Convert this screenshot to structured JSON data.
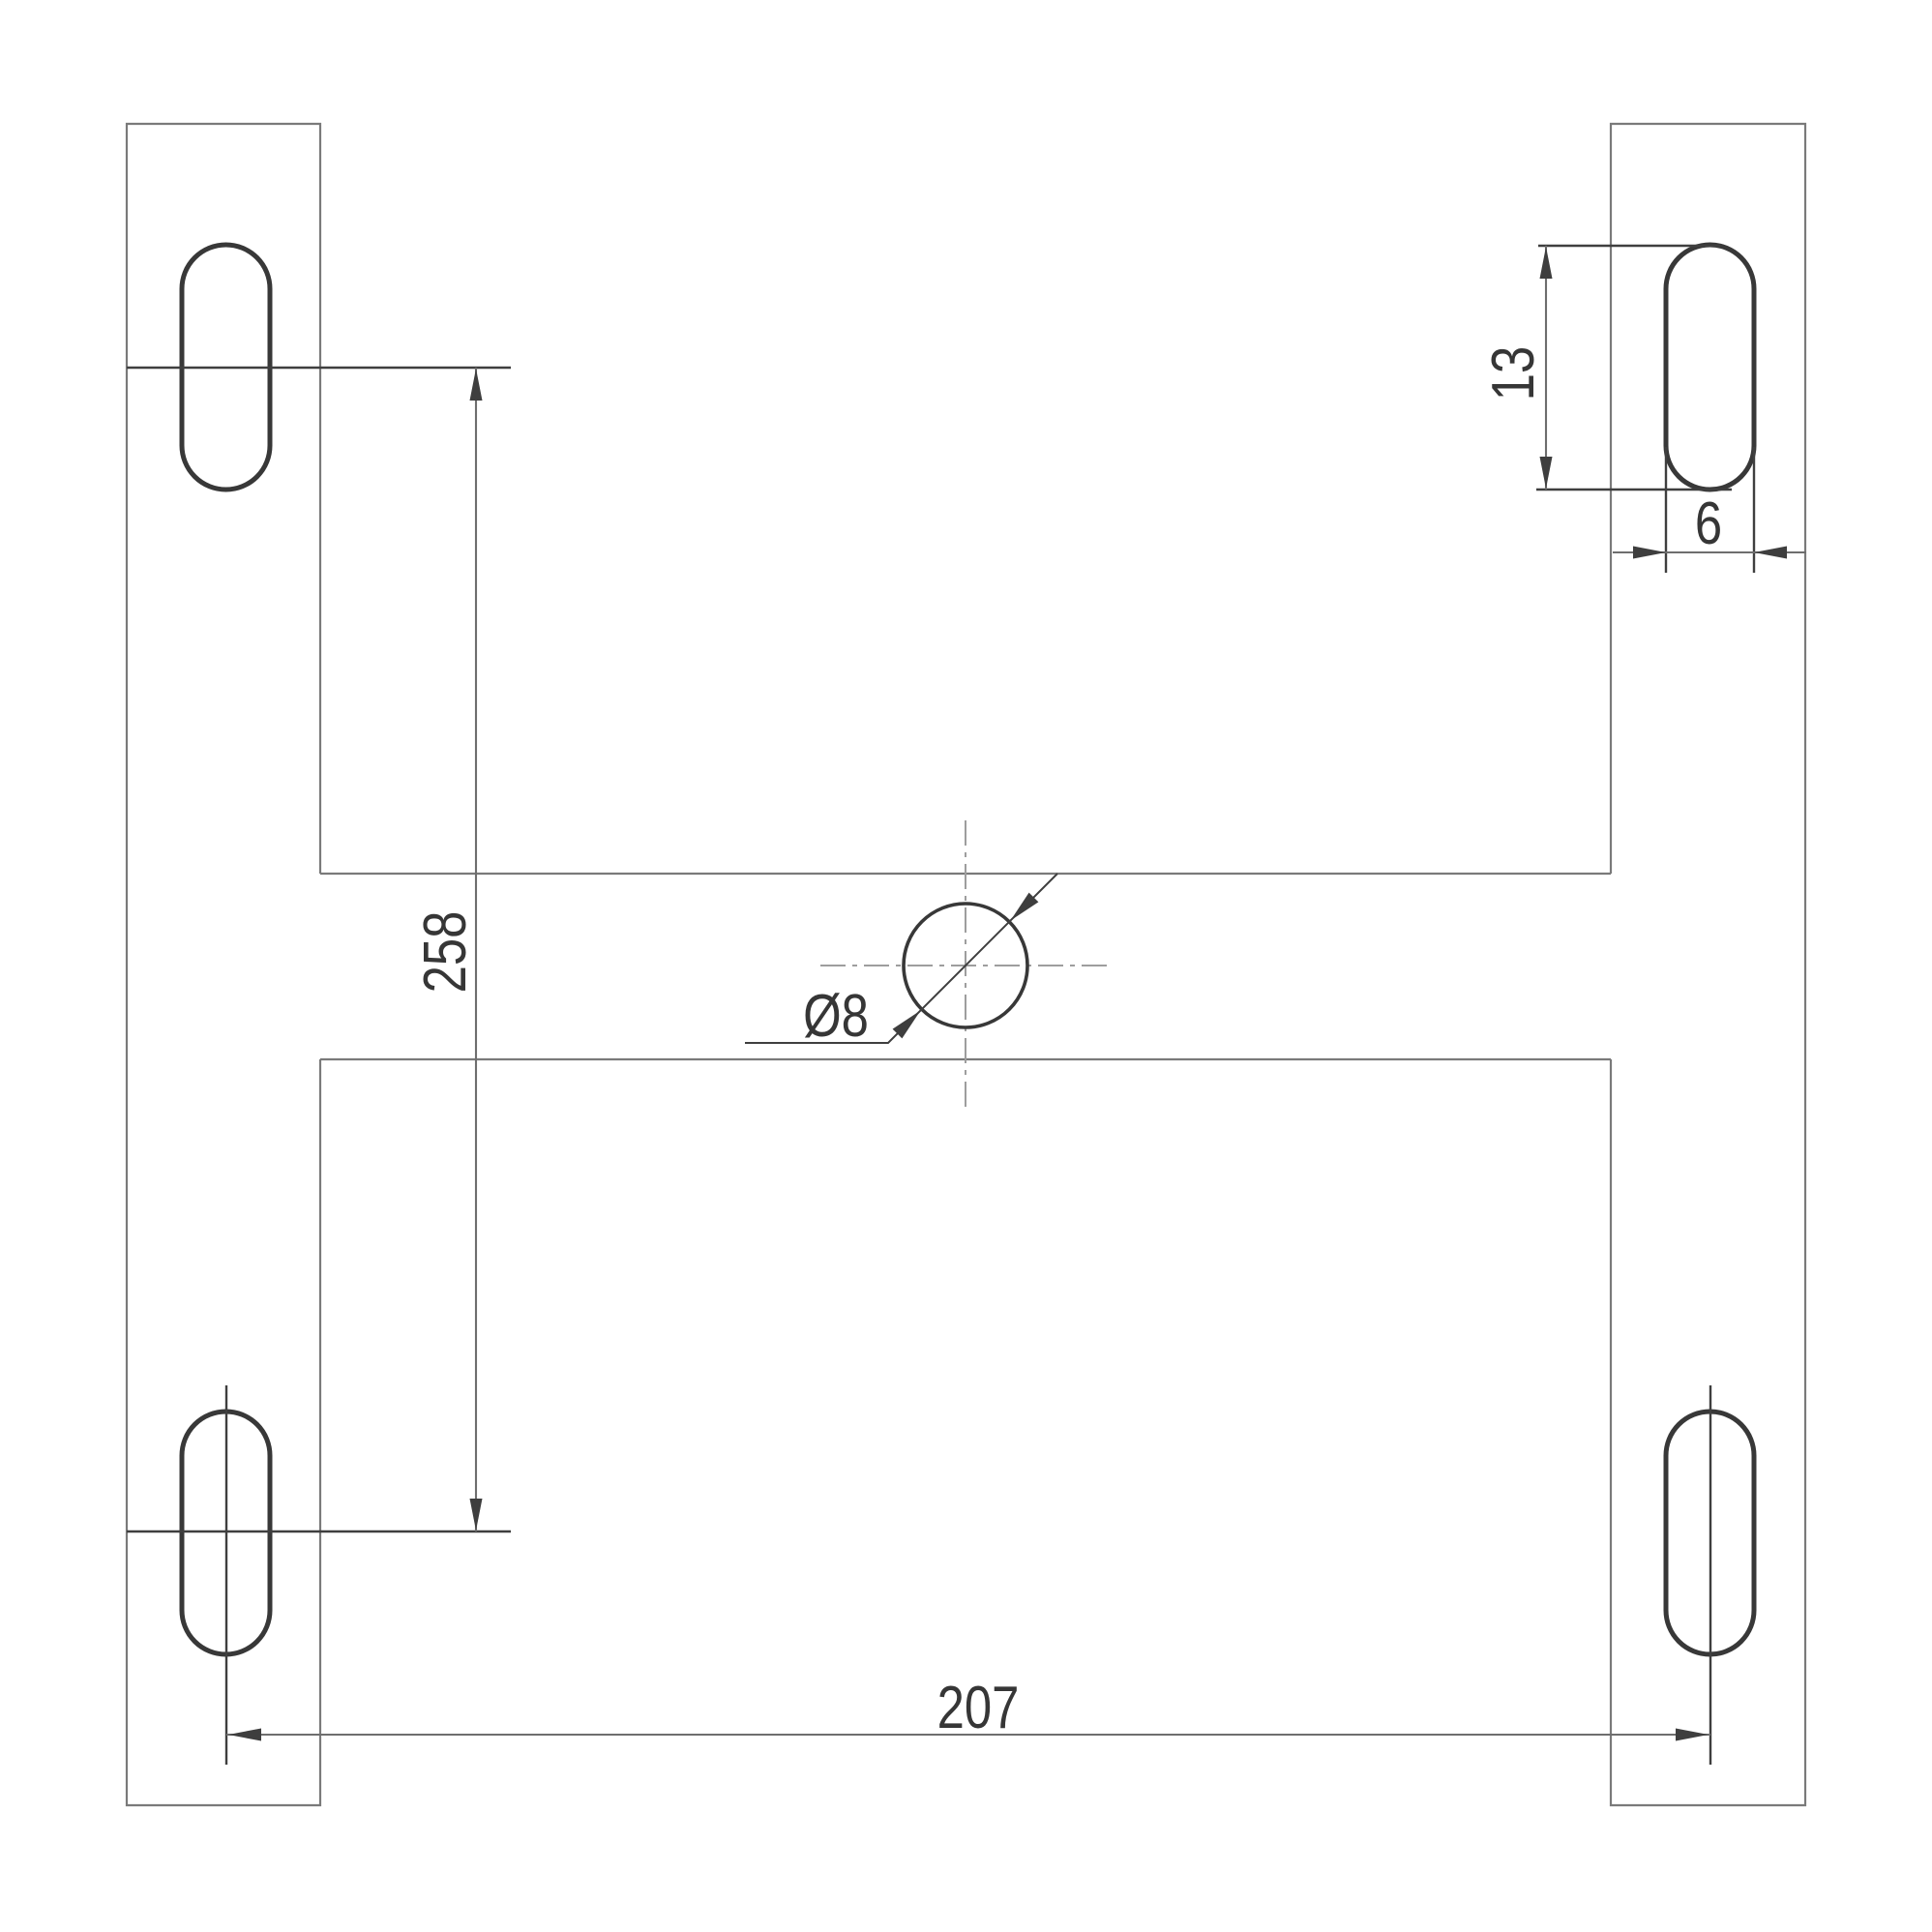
{
  "drawing": {
    "kind": "technical-dimension-drawing",
    "labels": {
      "vertical_slot_spacing": "258",
      "horizontal_slot_spacing": "207",
      "slot_length": "13",
      "slot_width": "6",
      "hole_diameter": "Ø8"
    },
    "colors": {
      "outline": "#7a7a7a",
      "feature": "#383838",
      "dimension": "#6e6e6e",
      "extension": "#3f3f3f",
      "centerline": "#9e9e9e",
      "arrow": "#3e3e3e",
      "text": "#363636"
    }
  }
}
